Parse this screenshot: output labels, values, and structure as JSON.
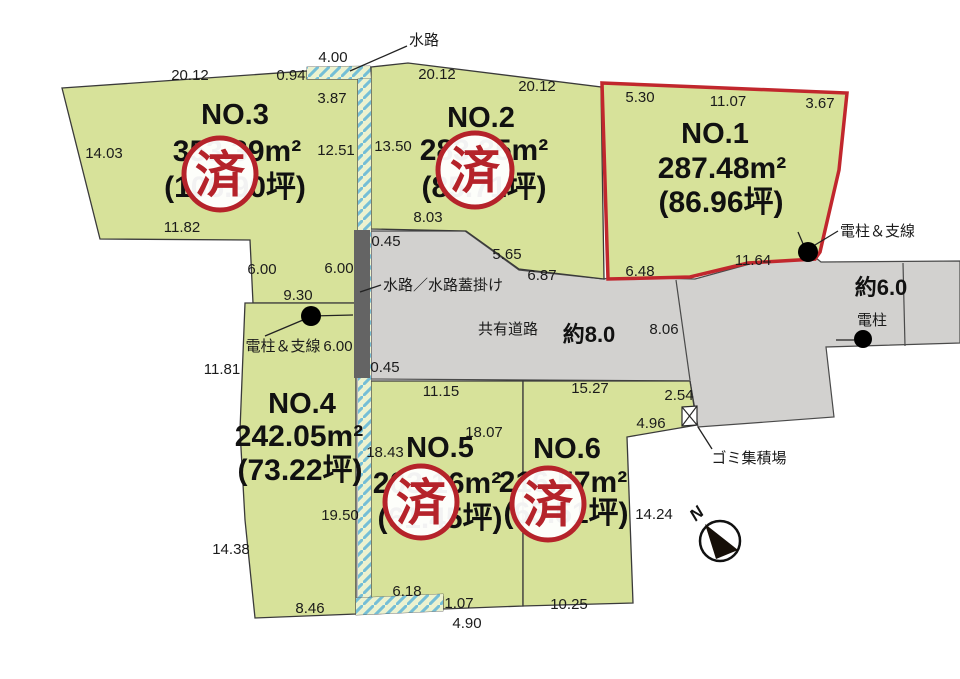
{
  "plots": [
    {
      "name": "NO.1",
      "area": "287.48m²",
      "tsubo": "(86.96坪)",
      "sold": false
    },
    {
      "name": "NO.2",
      "area": "283.35m²",
      "tsubo": "(85.71坪)",
      "sold": true
    },
    {
      "name": "NO.3",
      "area": "353.39m²",
      "tsubo": "(106.90坪)",
      "sold": true
    },
    {
      "name": "NO.4",
      "area": "242.05m²",
      "tsubo": "(73.22坪)",
      "sold": false
    },
    {
      "name": "NO.5",
      "area": "203.16m²",
      "tsubo": "(61.45坪)",
      "sold": true
    },
    {
      "name": "NO.6",
      "area": "216.57m²",
      "tsubo": "(65.51坪)",
      "sold": true
    }
  ],
  "stamp": "済",
  "labels": {
    "waterway": "水路",
    "waterway_covered": "水路／水路蓋掛け",
    "shared_road": "共有道路",
    "road_width_8": "約8.0",
    "road_width_6": "約6.0",
    "pole": "電柱",
    "pole_wire_right": "電柱＆支線",
    "pole_wire_left": "電柱＆支線",
    "garbage": "ゴミ集積場",
    "north": "N"
  },
  "colors": {
    "plot_green": "#d7e29a",
    "road_gray": "#d2d1cf",
    "covered_channel_gray": "#646464",
    "highlight_red": "#c1272d",
    "stamp_red": "#b5232a",
    "hatch_blue": "#74bed6"
  },
  "dims": [
    "4.00",
    "0.94",
    "20.12",
    "3.87",
    "14.03",
    "12.51",
    "11.82",
    "20.12",
    "20.12",
    "13.50",
    "8.03",
    "0.45",
    "5.65",
    "6.87",
    "5.30",
    "11.07",
    "3.67",
    "6.48",
    "11.64",
    "6.00",
    "6.00",
    "9.30",
    "6.00",
    "11.81",
    "0.45",
    "8.06",
    "11.15",
    "15.27",
    "2.54",
    "4.96",
    "18.43",
    "18.07",
    "19.50",
    "14.38",
    "14.24",
    "8.46",
    "6.18",
    "1.07",
    "4.90",
    "10.25"
  ]
}
